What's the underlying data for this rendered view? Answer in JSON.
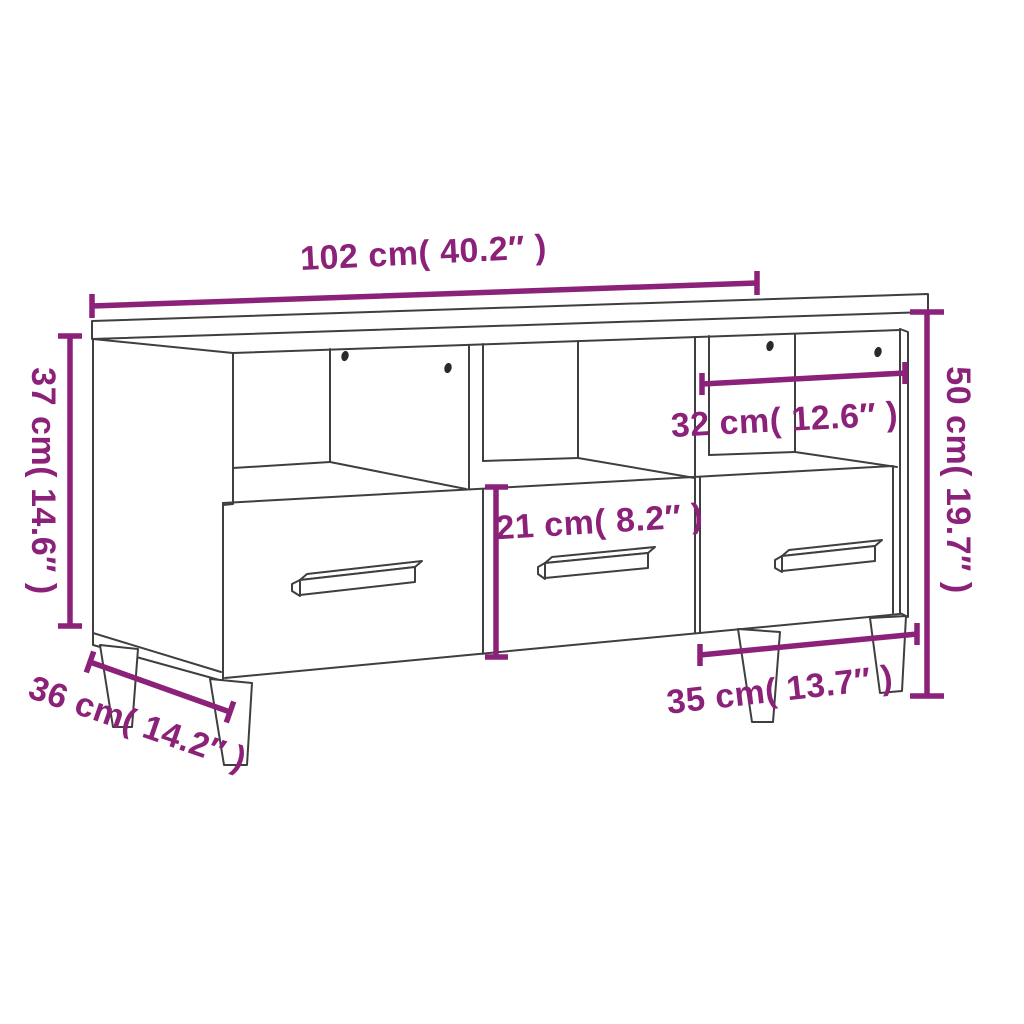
{
  "diagram": {
    "title": "TV cabinet dimension diagram",
    "product": "TV cabinet with 3 open compartments, 3 drawers and 4 tapered legs",
    "colors": {
      "accent": "#8B2178",
      "line_art": "#3F3F3F",
      "background": "#FFFFFF"
    },
    "labels": {
      "width": "102 cm( 40.2″ )",
      "side_height": "37 cm( 14.6″ )",
      "total_height": "50 cm( 19.7″ )",
      "shelf_opening_width": "32 cm( 12.6″ )",
      "drawer_front_height": "21 cm( 8.2″ )",
      "depth": "36 cm( 14.2″ )",
      "drawer_width": "35 cm( 13.7″ )"
    },
    "measurements": [
      {
        "part": "overall width",
        "cm": 102,
        "inch": 40.2
      },
      {
        "part": "carcass height",
        "cm": 37,
        "inch": 14.6
      },
      {
        "part": "total height",
        "cm": 50,
        "inch": 19.7
      },
      {
        "part": "compartment opening width",
        "cm": 32,
        "inch": 12.6
      },
      {
        "part": "drawer front height",
        "cm": 21,
        "inch": 8.2
      },
      {
        "part": "depth",
        "cm": 36,
        "inch": 14.2
      },
      {
        "part": "drawer width",
        "cm": 35,
        "inch": 13.7
      }
    ]
  }
}
